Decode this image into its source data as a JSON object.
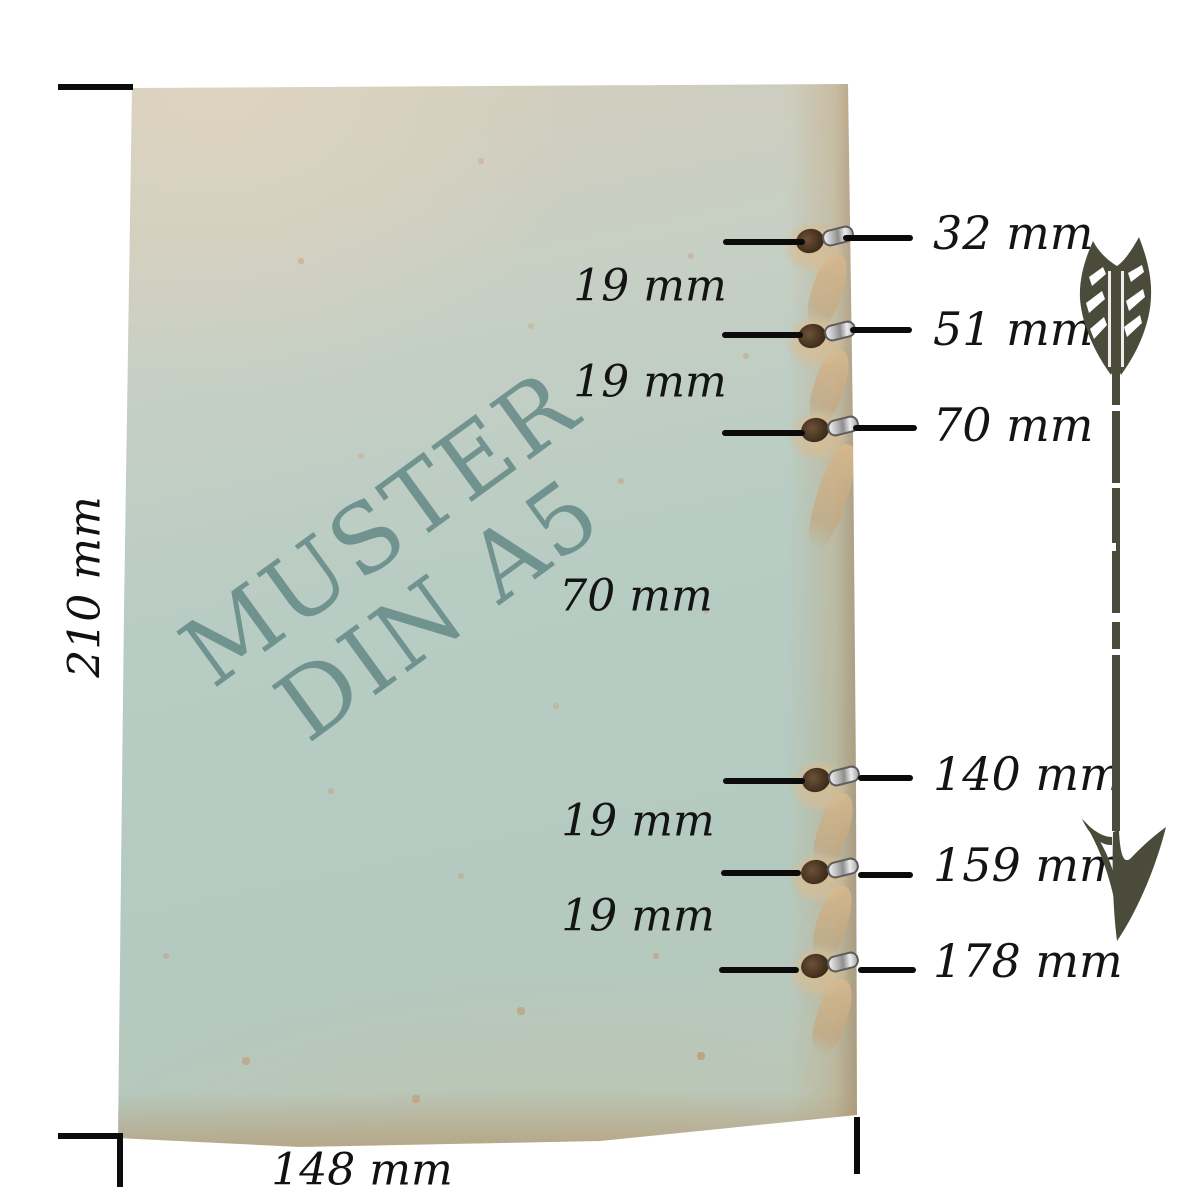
{
  "meta": {
    "description": "Dimension diagram of a DIN A5 notebook cover with eyelet hole positions"
  },
  "watermark": {
    "line1": "MUSTER",
    "line2": "DIN A5"
  },
  "page_dimensions": {
    "height_label": "210 mm",
    "width_label": "148 mm",
    "height_mm": 210,
    "width_mm": 148
  },
  "hole_callouts": [
    {
      "label": "32 mm",
      "mm": 32
    },
    {
      "label": "51 mm",
      "mm": 51
    },
    {
      "label": "70 mm",
      "mm": 70
    },
    {
      "label": "140 mm",
      "mm": 140
    },
    {
      "label": "159 mm",
      "mm": 159
    },
    {
      "label": "178 mm",
      "mm": 178
    }
  ],
  "gap_labels": [
    {
      "label": "19 mm",
      "mm": 19
    },
    {
      "label": "19 mm",
      "mm": 19
    },
    {
      "label": "70 mm",
      "mm": 70
    },
    {
      "label": "19 mm",
      "mm": 19
    },
    {
      "label": "19 mm",
      "mm": 19
    }
  ],
  "colors": {
    "paper_blue": "#b6cbc2",
    "paper_beige": "#d6cdbb",
    "edge_tan": "#c1a276",
    "watermark_teal": "#648886",
    "line_black": "#0b0b0b",
    "arrow_olive": "#4b4b3b",
    "eyelet_silver": "#c0c0c0",
    "hole_brown": "#4a3523"
  },
  "icons": {
    "arrow": "down-arrow-icon"
  }
}
